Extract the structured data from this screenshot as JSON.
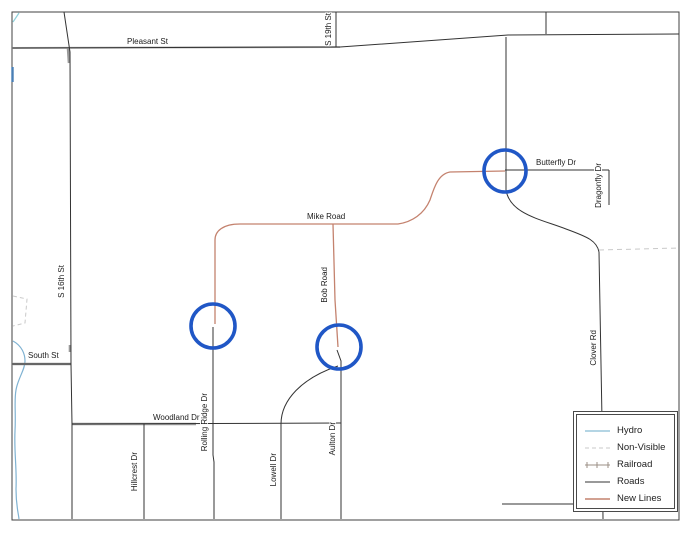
{
  "map": {
    "street_labels": {
      "pleasant_st": "Pleasant St",
      "s_19th_st": "S 19th St",
      "s_16th_st": "S 16th St",
      "south_st": "South St",
      "mike_road": "Mike Road",
      "bob_road": "Bob Road",
      "butterfly_dr": "Butterfly Dr",
      "dragonfly_dr": "Dragonfly Dr",
      "clover_rd": "Clover Rd",
      "woodland_dr": "Woodland Dr",
      "rolling_ridge_dr": "Rolling Ridge Dr",
      "hillcrest_dr": "Hillcrest Dr",
      "lowell_dr": "Lowell Dr",
      "aulton_dr": "Aulton Dr"
    },
    "colors": {
      "roads": "#333333",
      "road_casing": "#9a9a9a",
      "new_lines": "#c4826e",
      "hydro": "#8fbfd9",
      "hydro_dark": "#4a7fb5",
      "non_visible": "#c9c9c9",
      "railroad": "#9b8f85",
      "highlight_circle": "#2057c6",
      "border": "#404040"
    },
    "highlight_circle_count": 3
  },
  "legend": {
    "items": [
      {
        "label": "Hydro"
      },
      {
        "label": "Non-Visible"
      },
      {
        "label": "Railroad"
      },
      {
        "label": "Roads"
      },
      {
        "label": "New Lines"
      }
    ]
  }
}
